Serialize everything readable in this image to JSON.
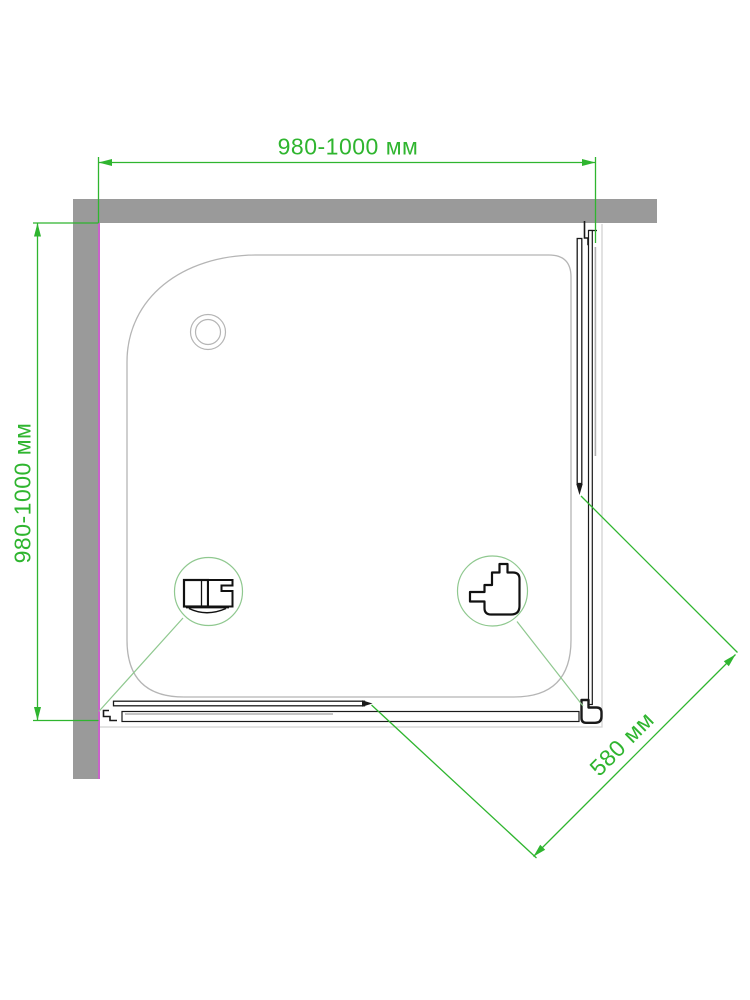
{
  "drawing": {
    "type": "shower-enclosure-top-view-technical-drawing",
    "labels": {
      "width_top": "980-1000 мм",
      "depth_left": "980-1000 мм",
      "door_opening_diagonal": "580 мм"
    },
    "colors": {
      "dimension_green": "#2fb52f",
      "detail_circle_green": "#8fc88f",
      "wall_gray": "#9a9a9a",
      "wall_inner_edge_magenta": "#c963c9",
      "tray_outline_gray": "#b5b5b5",
      "profile_black": "#1a1a1a"
    }
  }
}
